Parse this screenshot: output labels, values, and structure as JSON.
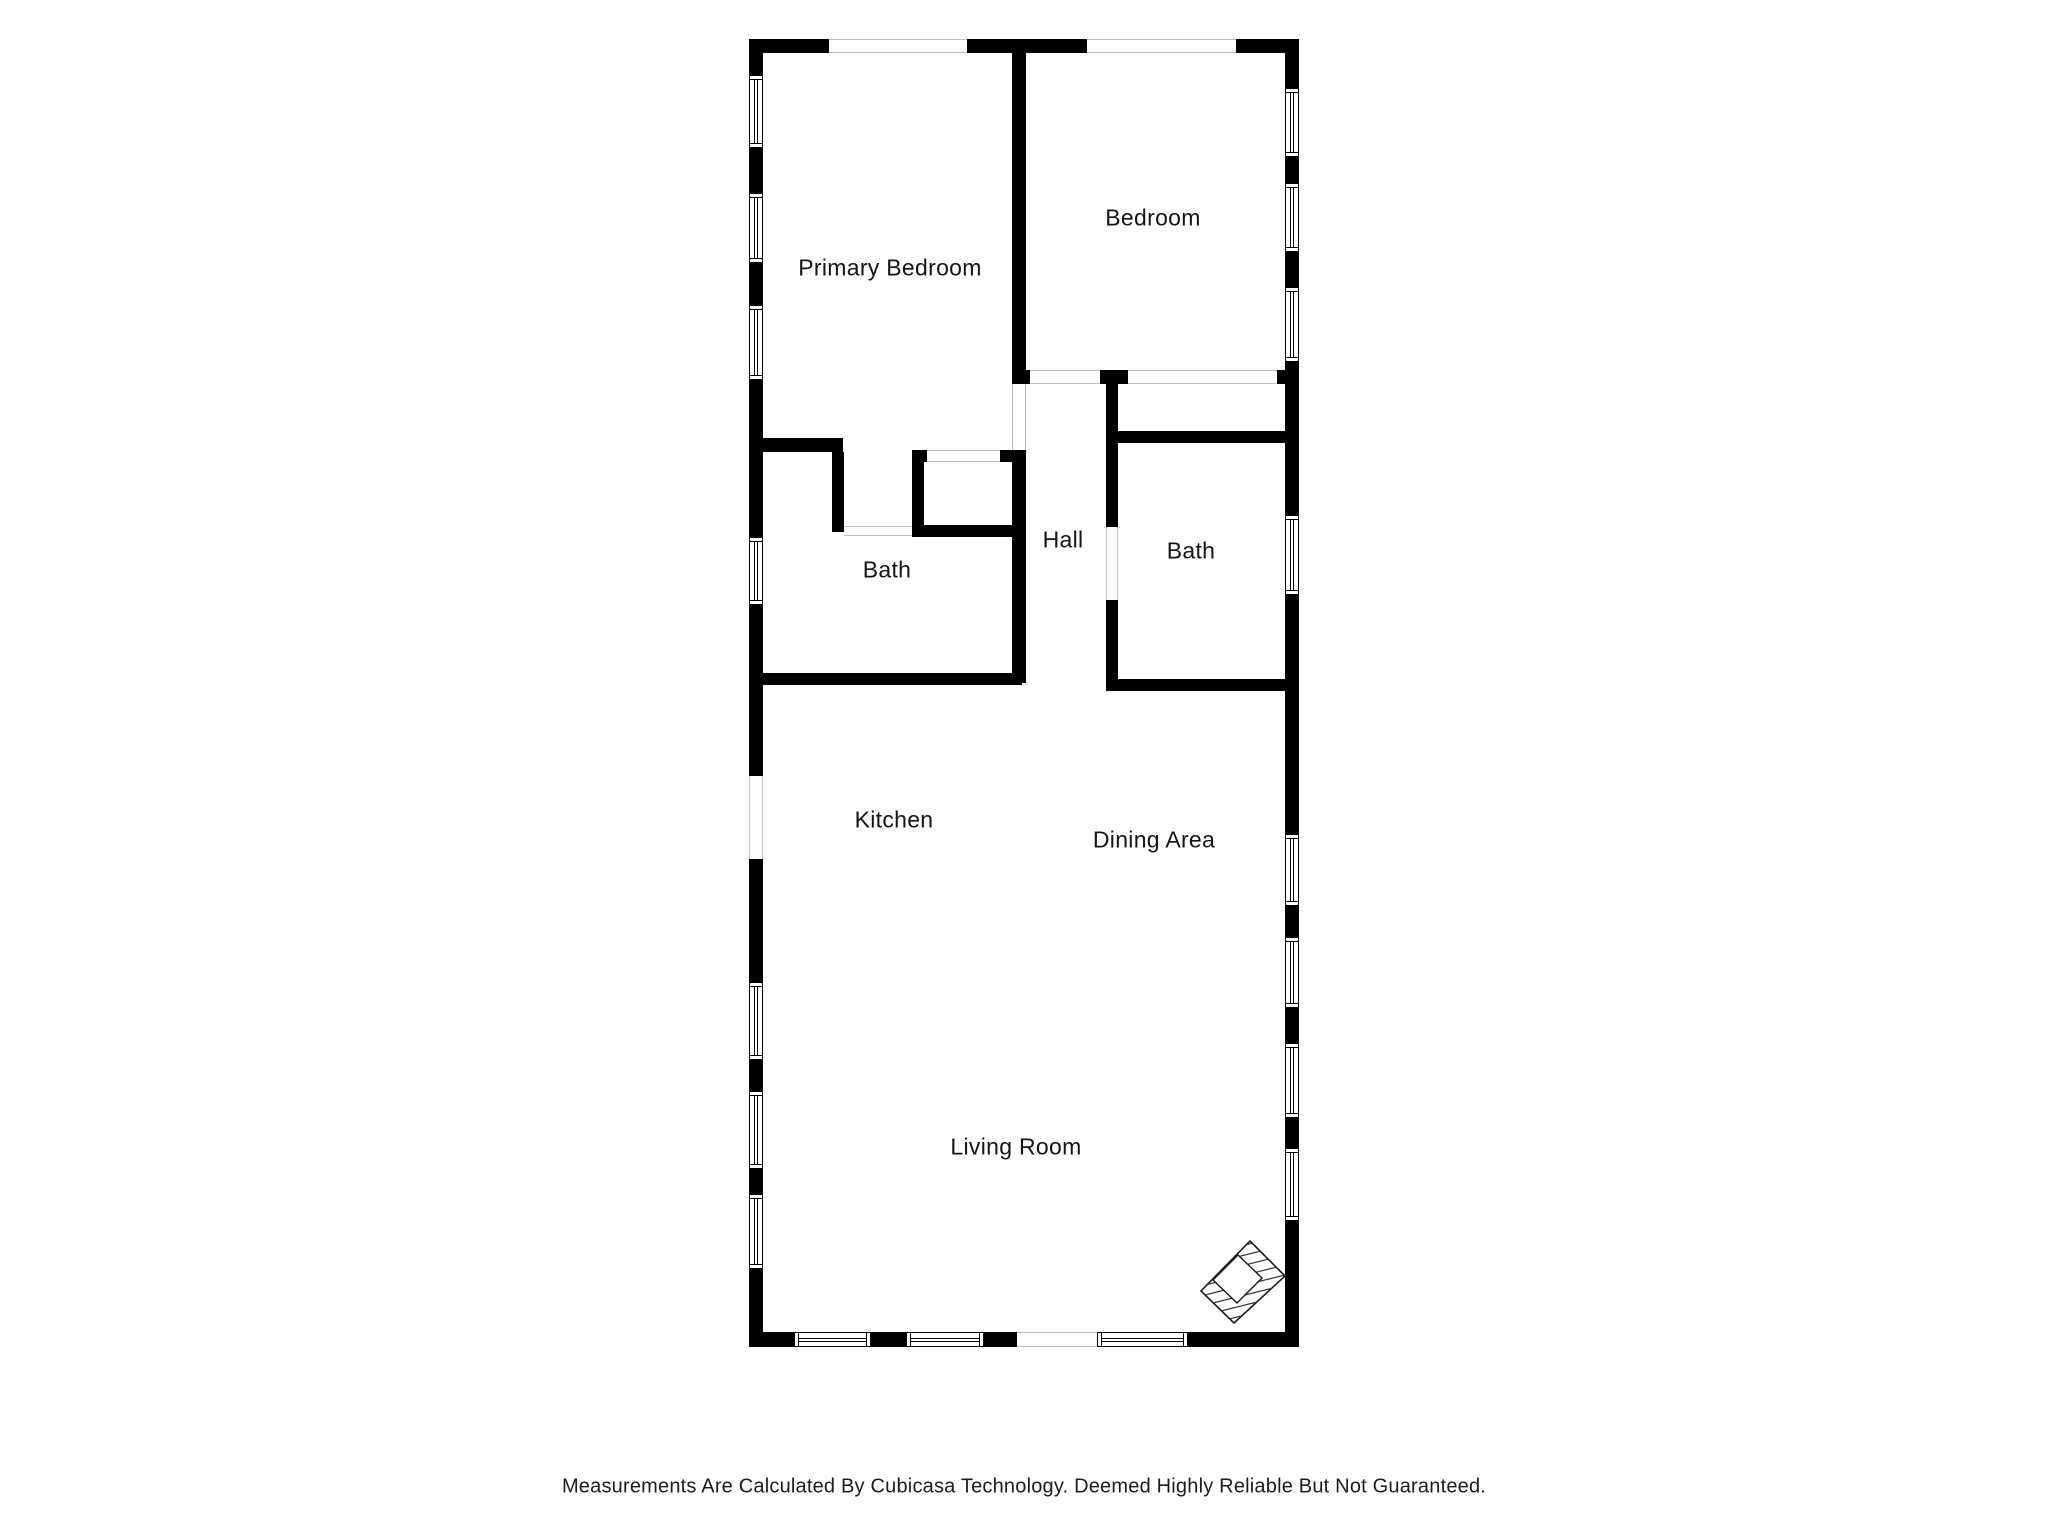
{
  "footer": {
    "disclaimer": "Measurements Are Calculated By Cubicasa Technology. Deemed Highly Reliable But Not Guaranteed."
  },
  "plan": {
    "colors": {
      "wall": "#000000",
      "opening_line": "#bdbdbd",
      "text": "#141414"
    },
    "rooms": [
      {
        "id": "primary-bedroom",
        "label": "Primary Bedroom",
        "cx": 890,
        "cy": 268
      },
      {
        "id": "bedroom",
        "label": "Bedroom",
        "cx": 1153,
        "cy": 218
      },
      {
        "id": "bath-1",
        "label": "Bath",
        "cx": 887,
        "cy": 570
      },
      {
        "id": "hall",
        "label": "Hall",
        "cx": 1063,
        "cy": 540
      },
      {
        "id": "bath-2",
        "label": "Bath",
        "cx": 1191,
        "cy": 551
      },
      {
        "id": "kitchen",
        "label": "Kitchen",
        "cx": 894,
        "cy": 820
      },
      {
        "id": "dining-area",
        "label": "Dining Area",
        "cx": 1154,
        "cy": 840
      },
      {
        "id": "living-room",
        "label": "Living Room",
        "cx": 1016,
        "cy": 1147
      }
    ],
    "walls": [
      {
        "x": 749,
        "y": 39,
        "w": 80,
        "h": 14
      },
      {
        "x": 967,
        "y": 39,
        "w": 120,
        "h": 14
      },
      {
        "x": 1236,
        "y": 39,
        "w": 63,
        "h": 14
      },
      {
        "x": 749,
        "y": 39,
        "w": 14,
        "h": 36
      },
      {
        "x": 749,
        "y": 148,
        "w": 14,
        "h": 45
      },
      {
        "x": 749,
        "y": 263,
        "w": 14,
        "h": 42
      },
      {
        "x": 749,
        "y": 380,
        "w": 14,
        "h": 157
      },
      {
        "x": 749,
        "y": 605,
        "w": 14,
        "h": 171
      },
      {
        "x": 749,
        "y": 859,
        "w": 14,
        "h": 123
      },
      {
        "x": 749,
        "y": 1060,
        "w": 14,
        "h": 31
      },
      {
        "x": 749,
        "y": 1169,
        "w": 14,
        "h": 25
      },
      {
        "x": 749,
        "y": 1269,
        "w": 14,
        "h": 78
      },
      {
        "x": 1285,
        "y": 39,
        "w": 14,
        "h": 49
      },
      {
        "x": 1285,
        "y": 157,
        "w": 14,
        "h": 26
      },
      {
        "x": 1285,
        "y": 252,
        "w": 14,
        "h": 35
      },
      {
        "x": 1285,
        "y": 362,
        "w": 14,
        "h": 153
      },
      {
        "x": 1285,
        "y": 595,
        "w": 14,
        "h": 239
      },
      {
        "x": 1285,
        "y": 906,
        "w": 14,
        "h": 31
      },
      {
        "x": 1285,
        "y": 1008,
        "w": 14,
        "h": 35
      },
      {
        "x": 1285,
        "y": 1118,
        "w": 14,
        "h": 30
      },
      {
        "x": 1285,
        "y": 1221,
        "w": 14,
        "h": 126
      },
      {
        "x": 749,
        "y": 1332,
        "w": 45,
        "h": 15
      },
      {
        "x": 871,
        "y": 1332,
        "w": 35,
        "h": 15
      },
      {
        "x": 984,
        "y": 1332,
        "w": 33,
        "h": 15
      },
      {
        "x": 1188,
        "y": 1332,
        "w": 111,
        "h": 15
      },
      {
        "x": 1012,
        "y": 39,
        "w": 14,
        "h": 345
      },
      {
        "x": 1012,
        "y": 450,
        "w": 14,
        "h": 233
      },
      {
        "x": 1012,
        "y": 370,
        "w": 18,
        "h": 14
      },
      {
        "x": 1100,
        "y": 370,
        "w": 28,
        "h": 14
      },
      {
        "x": 1277,
        "y": 370,
        "w": 22,
        "h": 14
      },
      {
        "x": 912,
        "y": 450,
        "w": 12,
        "h": 87
      },
      {
        "x": 912,
        "y": 525,
        "w": 110,
        "h": 12
      },
      {
        "x": 912,
        "y": 450,
        "w": 15,
        "h": 12
      },
      {
        "x": 1000,
        "y": 450,
        "w": 22,
        "h": 12
      },
      {
        "x": 763,
        "y": 438,
        "w": 80,
        "h": 14
      },
      {
        "x": 832,
        "y": 452,
        "w": 12,
        "h": 80
      },
      {
        "x": 763,
        "y": 673,
        "w": 259,
        "h": 12
      },
      {
        "x": 1106,
        "y": 384,
        "w": 12,
        "h": 143
      },
      {
        "x": 1106,
        "y": 600,
        "w": 12,
        "h": 91
      },
      {
        "x": 1118,
        "y": 431,
        "w": 180,
        "h": 12
      },
      {
        "x": 1106,
        "y": 679,
        "w": 192,
        "h": 12
      }
    ],
    "windows": [
      {
        "x": 749,
        "y": 75,
        "w": 14,
        "h": 73,
        "o": "v"
      },
      {
        "x": 749,
        "y": 193,
        "w": 14,
        "h": 70,
        "o": "v"
      },
      {
        "x": 749,
        "y": 305,
        "w": 14,
        "h": 75,
        "o": "v"
      },
      {
        "x": 749,
        "y": 537,
        "w": 14,
        "h": 68,
        "o": "v"
      },
      {
        "x": 749,
        "y": 982,
        "w": 14,
        "h": 78,
        "o": "v"
      },
      {
        "x": 749,
        "y": 1091,
        "w": 14,
        "h": 78,
        "o": "v"
      },
      {
        "x": 749,
        "y": 1194,
        "w": 14,
        "h": 75,
        "o": "v"
      },
      {
        "x": 1285,
        "y": 88,
        "w": 14,
        "h": 69,
        "o": "v"
      },
      {
        "x": 1285,
        "y": 183,
        "w": 14,
        "h": 69,
        "o": "v"
      },
      {
        "x": 1285,
        "y": 287,
        "w": 14,
        "h": 75,
        "o": "v"
      },
      {
        "x": 1285,
        "y": 515,
        "w": 14,
        "h": 80,
        "o": "v"
      },
      {
        "x": 1285,
        "y": 834,
        "w": 14,
        "h": 72,
        "o": "v"
      },
      {
        "x": 1285,
        "y": 937,
        "w": 14,
        "h": 71,
        "o": "v"
      },
      {
        "x": 1285,
        "y": 1043,
        "w": 14,
        "h": 75,
        "o": "v"
      },
      {
        "x": 1285,
        "y": 1148,
        "w": 14,
        "h": 73,
        "o": "v"
      },
      {
        "x": 794,
        "y": 1332,
        "w": 77,
        "h": 15,
        "o": "h"
      },
      {
        "x": 906,
        "y": 1332,
        "w": 78,
        "h": 15,
        "o": "h"
      },
      {
        "x": 1097,
        "y": 1332,
        "w": 91,
        "h": 15,
        "o": "h"
      }
    ],
    "openings": [
      {
        "x": 829,
        "y": 39,
        "w": 138,
        "h": 14,
        "o": "h"
      },
      {
        "x": 1087,
        "y": 39,
        "w": 149,
        "h": 14,
        "o": "h"
      },
      {
        "x": 749,
        "y": 776,
        "w": 14,
        "h": 83,
        "o": "v"
      },
      {
        "x": 1017,
        "y": 1332,
        "w": 80,
        "h": 15,
        "o": "h"
      },
      {
        "x": 1030,
        "y": 370,
        "w": 70,
        "h": 14,
        "o": "h"
      },
      {
        "x": 1128,
        "y": 370,
        "w": 149,
        "h": 14,
        "o": "h"
      },
      {
        "x": 1012,
        "y": 384,
        "w": 14,
        "h": 66,
        "o": "v"
      },
      {
        "x": 1106,
        "y": 527,
        "w": 12,
        "h": 73,
        "o": "v"
      },
      {
        "x": 844,
        "y": 526,
        "w": 68,
        "h": 10,
        "o": "h"
      },
      {
        "x": 927,
        "y": 450,
        "w": 73,
        "h": 12,
        "o": "h"
      }
    ]
  }
}
